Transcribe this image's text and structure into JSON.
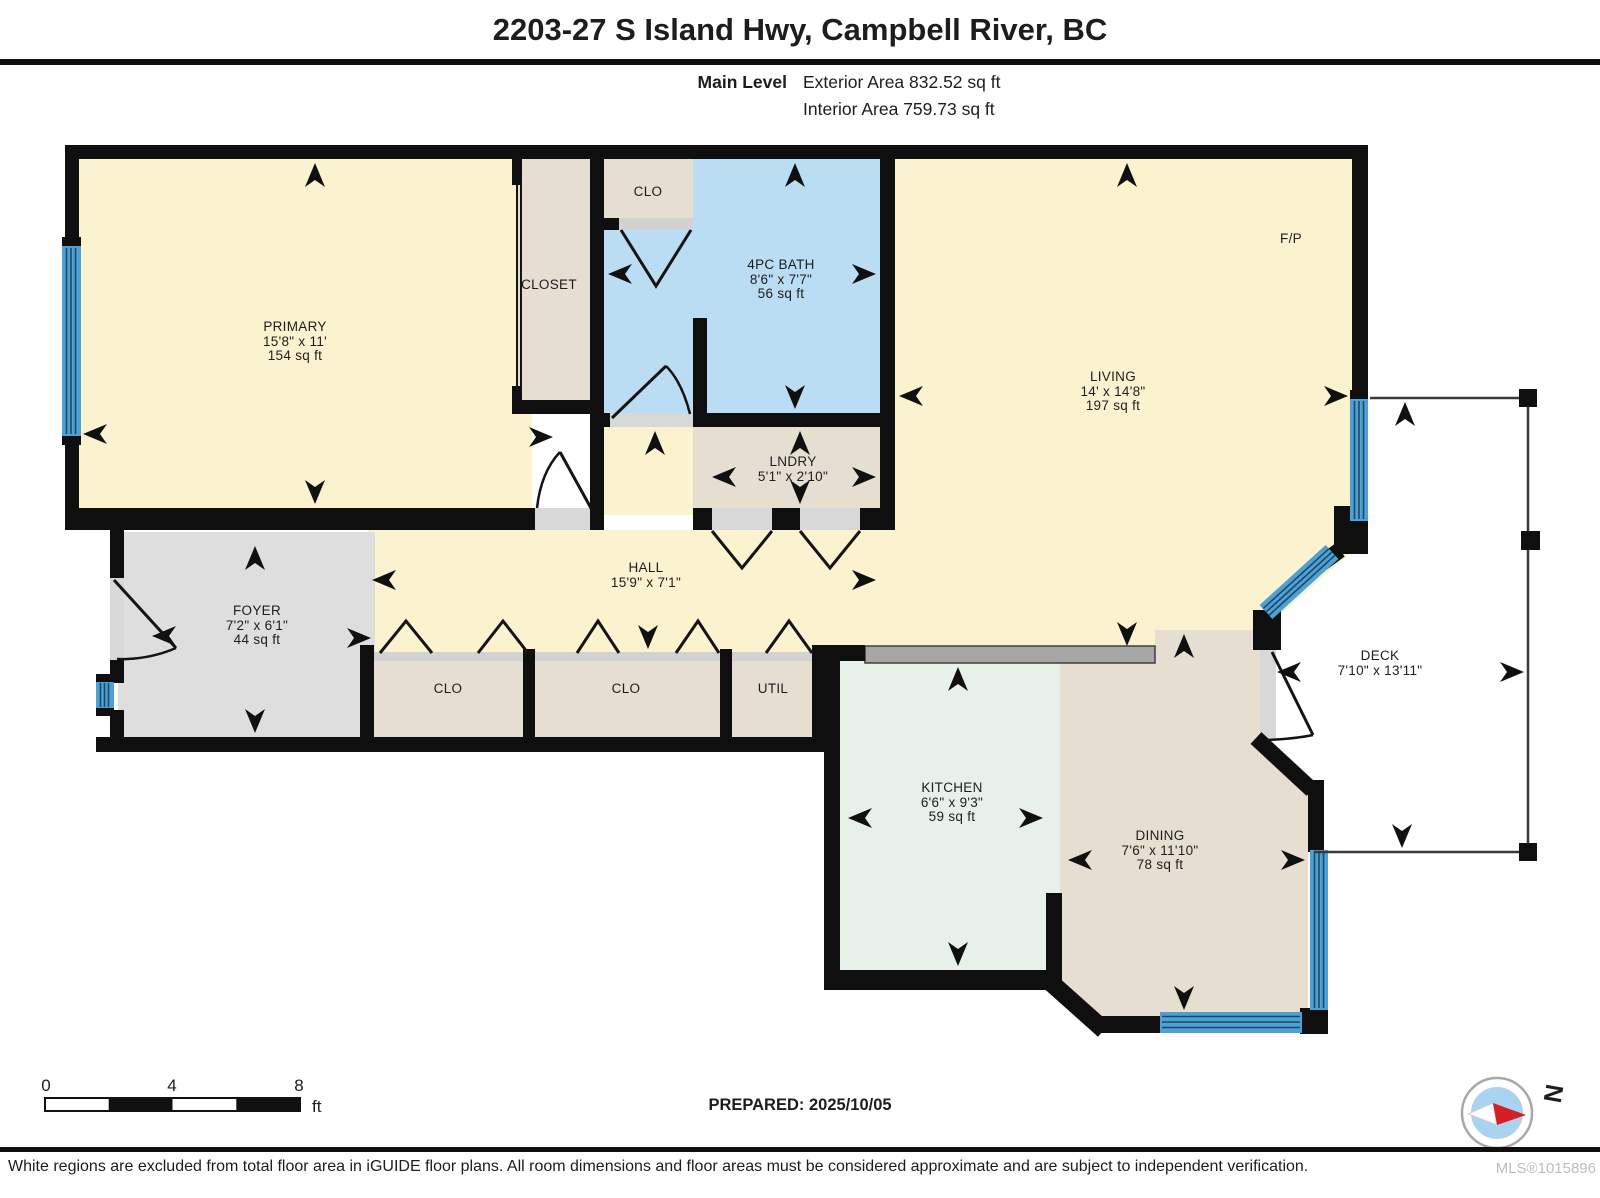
{
  "header": {
    "title": "2203-27 S Island Hwy, Campbell River, BC",
    "level_label": "Main Level",
    "exterior_area": "Exterior Area 832.52 sq ft",
    "interior_area": "Interior Area 759.73 sq ft"
  },
  "rooms": {
    "primary": {
      "name": "PRIMARY",
      "dims": "15'8\" x 11'",
      "area": "154 sq ft"
    },
    "closet": {
      "name": "CLOSET"
    },
    "clo_top": {
      "name": "CLO"
    },
    "bath": {
      "name": "4PC BATH",
      "dims": "8'6\" x 7'7\"",
      "area": "56 sq ft"
    },
    "living": {
      "name": "LIVING",
      "dims": "14' x 14'8\"",
      "area": "197 sq ft"
    },
    "fireplace": {
      "name": "F/P"
    },
    "lndry": {
      "name": "LNDRY",
      "dims": "5'1\" x 2'10\""
    },
    "hall": {
      "name": "HALL",
      "dims": "15'9\" x 7'1\""
    },
    "foyer": {
      "name": "FOYER",
      "dims": "7'2\" x 6'1\"",
      "area": "44 sq ft"
    },
    "clo1": {
      "name": "CLO"
    },
    "clo2": {
      "name": "CLO"
    },
    "util": {
      "name": "UTIL"
    },
    "kitchen": {
      "name": "KITCHEN",
      "dims": "6'6\" x 9'3\"",
      "area": "59 sq ft"
    },
    "dining": {
      "name": "DINING",
      "dims": "7'6\" x 11'10\"",
      "area": "78 sq ft"
    },
    "deck": {
      "name": "DECK",
      "dims": "7'10\" x 13'11\""
    }
  },
  "scale_bar": {
    "tick0": "0",
    "tick4": "4",
    "tick8": "8",
    "unit": "ft"
  },
  "footer": {
    "prepared": "PREPARED: 2025/10/05",
    "compass_label": "N",
    "disclaimer": "White regions are excluded from total floor area in iGUIDE floor plans. All room dimensions and floor areas must be considered approximate and are subject to independent verification.",
    "mls": "MLS®1015896"
  },
  "colors": {
    "room_cream": "#FBF2D0",
    "room_beige": "#E6DED1",
    "room_blue": "#BBDDF3",
    "room_green": "#E8F0EA",
    "room_gray": "#DEDEDE",
    "window_blue": "#4FA0D4",
    "wall_black": "#0F0F0F",
    "counter_gray": "#A6A6A6",
    "compass_red": "#D51F26",
    "compass_blue": "#A9D3EF"
  }
}
